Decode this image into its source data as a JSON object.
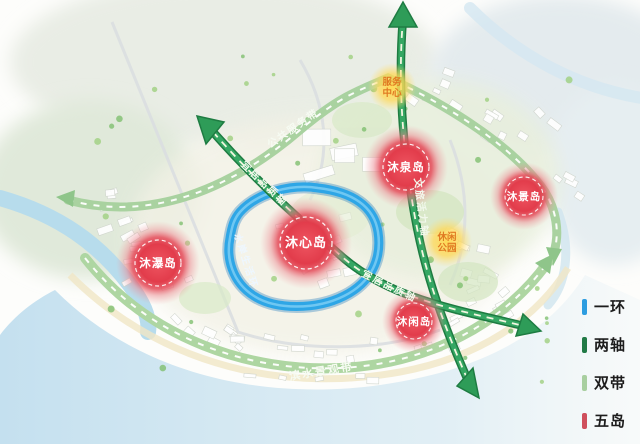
{
  "map": {
    "islands": {
      "xin": "沐心岛",
      "quan": "沐泉岛",
      "jing": "沐景岛",
      "pu": "沐瀑岛",
      "xian": "沐闲岛"
    },
    "nodes": {
      "service": {
        "line1": "服务",
        "line2": "中心"
      },
      "park": {
        "line1": "休闲",
        "line2": "公园"
      }
    },
    "axes": {
      "vertical": "文旅活力轴",
      "diagonal": "宜居品质轴"
    },
    "belts": {
      "top": "公共服务带",
      "bottom": "滨水景观带"
    },
    "ring": {
      "label": "水岸生活环"
    },
    "colors": {
      "ring_blue": "#2ea6e6",
      "axis_green": "#2e9c58",
      "belt_green": "#a9d2a0",
      "island_red": "#e23c4b",
      "node_yellow": "#ffd94f"
    }
  },
  "legend": {
    "items": [
      {
        "label": "一环",
        "color": "#2d9de0"
      },
      {
        "label": "两轴",
        "color": "#217a46"
      },
      {
        "label": "双带",
        "color": "#a8cfa0"
      },
      {
        "label": "五岛",
        "color": "#cf4f5c"
      }
    ]
  }
}
